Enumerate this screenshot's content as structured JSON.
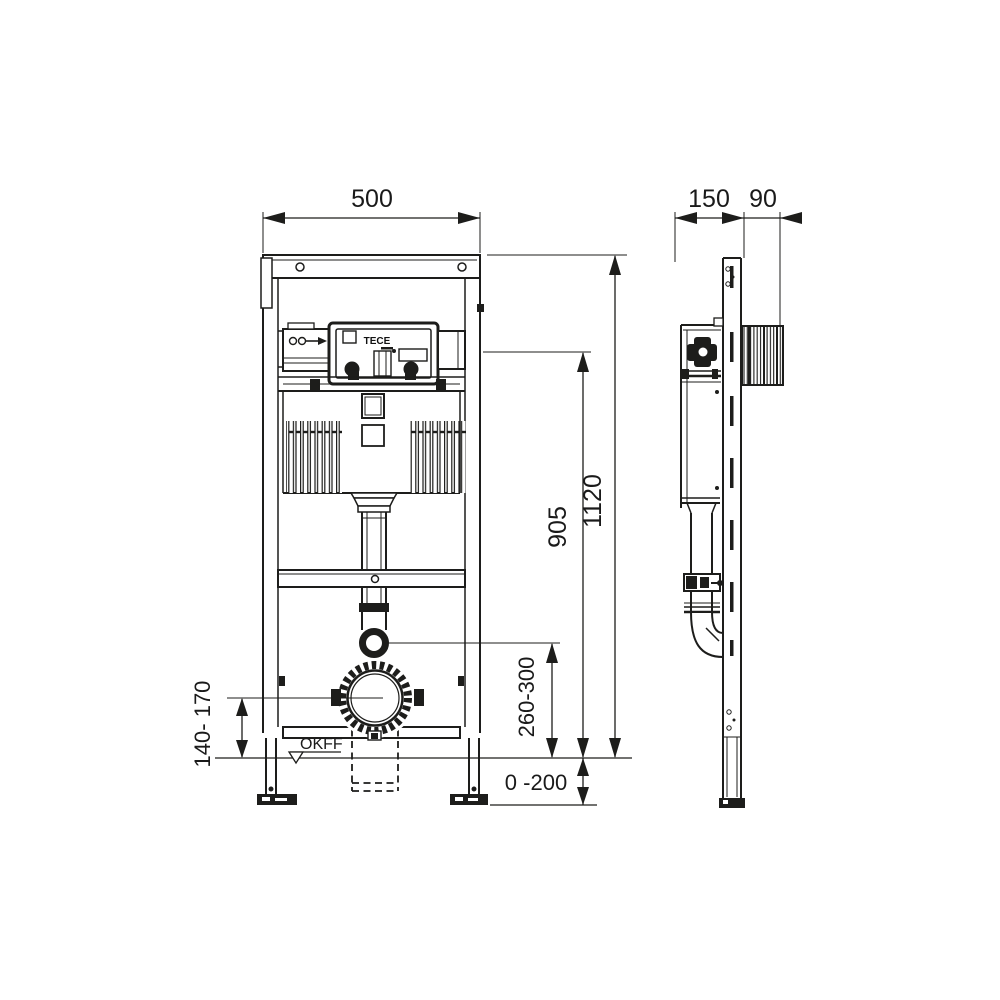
{
  "labels": {
    "brand": "TECE",
    "floor_level": "OKFF"
  },
  "dimensions": {
    "front_width": "500",
    "total_height": "1120",
    "upper_height": "905",
    "outlet_height": "260-300",
    "drain_height": "140- 170",
    "floor_adjust": "0 -200",
    "side_depth": "150",
    "side_protrusion": "90"
  },
  "colors": {
    "line": "#1d1d1b",
    "background": "#ffffff"
  }
}
